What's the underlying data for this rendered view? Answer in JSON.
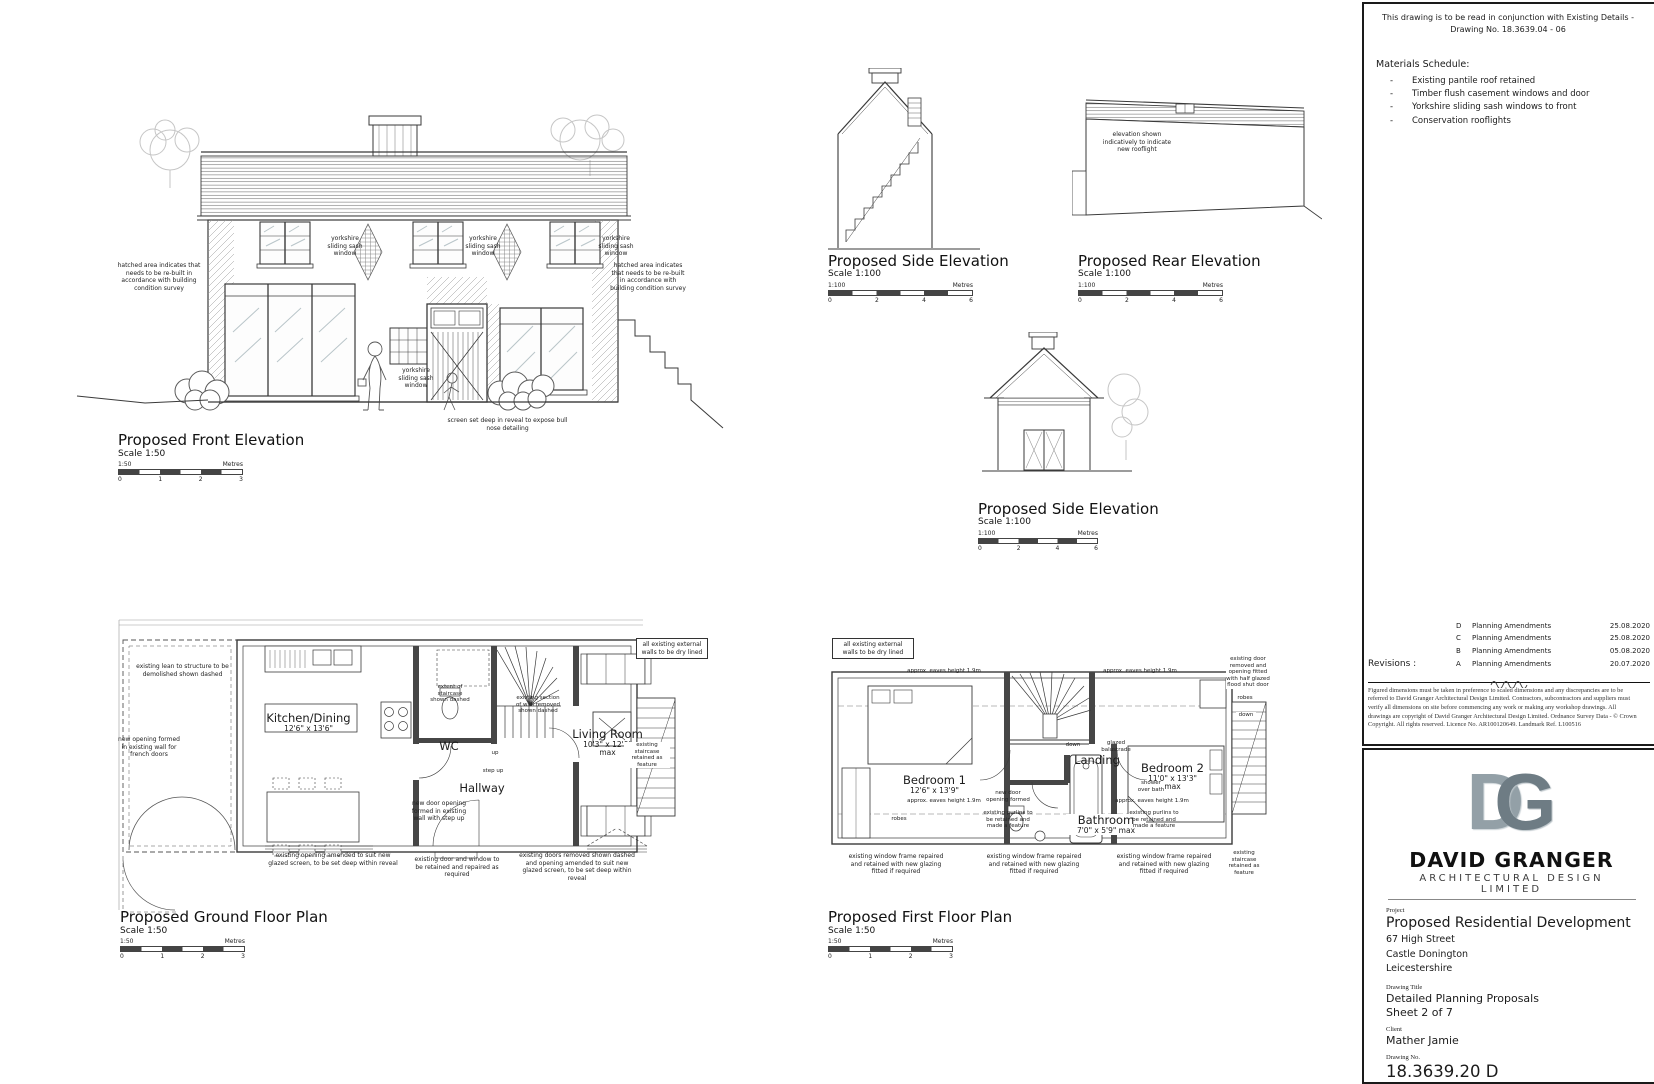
{
  "views": {
    "front": {
      "title": "Proposed Front Elevation",
      "scale": "Scale 1:50"
    },
    "side_top": {
      "title": "Proposed Side Elevation",
      "scale": "Scale 1:100"
    },
    "rear": {
      "title": "Proposed Rear Elevation",
      "scale": "Scale 1:100"
    },
    "side_mid": {
      "title": "Proposed Side Elevation",
      "scale": "Scale 1:100"
    },
    "ground": {
      "title": "Proposed Ground Floor Plan",
      "scale": "Scale 1:50"
    },
    "first": {
      "title": "Proposed First Floor Plan",
      "scale": "Scale 1:50"
    }
  },
  "scalebars": {
    "unit": "Metres",
    "s50": {
      "ratio": "1:50",
      "ticks": [
        "0",
        "1",
        "2",
        "3"
      ]
    },
    "s100": {
      "ratio": "1:100",
      "ticks": [
        "0",
        "2",
        "4",
        "6"
      ]
    }
  },
  "front": {
    "hatched_note": "hatched area indicates that needs to be re-built in accordance with building condition survey",
    "sash_label": "yorkshire sliding sash window",
    "screen_note": "screen set deep in reveal to expose bull nose detailing"
  },
  "rear": {
    "rooflight_note": "elevation shown indicatively to indicate new rooflight"
  },
  "ground": {
    "rooms": {
      "kitchen": {
        "name": "Kitchen/Dining",
        "dims": "12'6\" x 13'6\""
      },
      "wc": "WC",
      "hallway": "Hallway",
      "living": {
        "name": "Living Room",
        "dims": "10'3\" x 12'9\"",
        "max": "max"
      }
    },
    "ann": {
      "lean_to": "existing lean to structure to be demolished shown dashed",
      "french_doors": "new opening formed in existing wall for french doors",
      "dry_lined": "all existing external walls to be dry lined",
      "stair_extent": "extent of staircase shown dashed",
      "wall_removed": "existing section of wall removed shown dashed",
      "up": "up",
      "step_up": "step up",
      "new_door": "new door opening formed in existing wall with step up",
      "opening_amended": "existing opening amended to suit new glazed screen, to be set deep within reveal",
      "door_retained": "existing door and window to be retained and repaired as required",
      "doors_removed": "existing doors removed shown dashed and opening amended to suit new glazed screen, to be set deep within reveal",
      "stair_feature": "existing staircase retained as feature"
    }
  },
  "first": {
    "rooms": {
      "bed1": {
        "name": "Bedroom 1",
        "dims": "12'6\" x 13'9\""
      },
      "bed2": {
        "name": "Bedroom 2",
        "dims": "11'0\" x 13'3\"",
        "max": "max"
      },
      "bathroom": {
        "name": "Bathroom",
        "dims": "7'0\" x 5'9\" max"
      },
      "landing": "Landing"
    },
    "ann": {
      "dry_lined": "all existing external walls to be dry lined",
      "eaves": "approx. eaves height 1.9m",
      "robes": "robes",
      "down": "down",
      "glazed_balustrade": "glazed balustrade",
      "new_door": "new door opening formed",
      "purlins": "existing purlins to be retained and made a feature",
      "shower": "shower over bath",
      "door_removed": "existing door removed and opening fitted with half glazed flood shut door",
      "window_frame": "existing window frame repaired and retained with new glazing fitted if required",
      "stair_feature": "existing staircase retained as feature"
    }
  },
  "notes_panel": {
    "conjunction_note": "This drawing is to be read in conjunction with Existing Details - Drawing No. 18.3639.04 - 06",
    "materials": {
      "title": "Materials Schedule:",
      "items": [
        "Existing pantile roof retained",
        "Timber flush casement windows and door",
        "Yorkshire sliding sash windows to front",
        "Conservation rooflights"
      ]
    },
    "revisions": {
      "label": "Revisions :",
      "rows": [
        {
          "letter": "D",
          "desc": "Planning Amendments",
          "date": "25.08.2020"
        },
        {
          "letter": "C",
          "desc": "Planning Amendments",
          "date": "25.08.2020"
        },
        {
          "letter": "B",
          "desc": "Planning Amendments",
          "date": "05.08.2020"
        },
        {
          "letter": "A",
          "desc": "Planning Amendments",
          "date": "20.07.2020"
        }
      ]
    },
    "disclaimer": "Figured dimensions must be taken in preference to scaled dimensions and any discrepancies are to be referred to David Granger Architectural Design Limited. Contractors, subcontractors and suppliers must verify all dimensions on site before commencing any work or making any workshop drawings. All drawings are copyright of David Granger Architectural Design Limited. Ordnance Survey Data - © Crown Copyright. All rights reserved. Licence No. AR100120649. Landmark Ref. L100516"
  },
  "title_block": {
    "logo_d": "D",
    "logo_g": "G",
    "firm_name": "DAVID GRANGER",
    "firm_subtitle": "ARCHITECTURAL DESIGN LIMITED",
    "project_label": "Project",
    "project_name": "Proposed  Residential  Development",
    "address": [
      "67  High  Street",
      "Castle  Donington",
      "Leicestershire"
    ],
    "drawing_title_label": "Drawing Title",
    "drawing_title": "Detailed  Planning  Proposals",
    "sheet": "Sheet  2  of  7",
    "client_label": "Client",
    "client": "Mather  Jamie",
    "drawing_no_label": "Drawing No.",
    "drawing_no": "18.3639.20  D",
    "date_label": "Date",
    "date": "January  2020",
    "scale_label": "Scale @A1 Size",
    "scale": "As  Shown",
    "drawn_label": "Drawn By",
    "drawn": "AS/SH",
    "checked_label": "Checked By",
    "checked": "DG"
  }
}
